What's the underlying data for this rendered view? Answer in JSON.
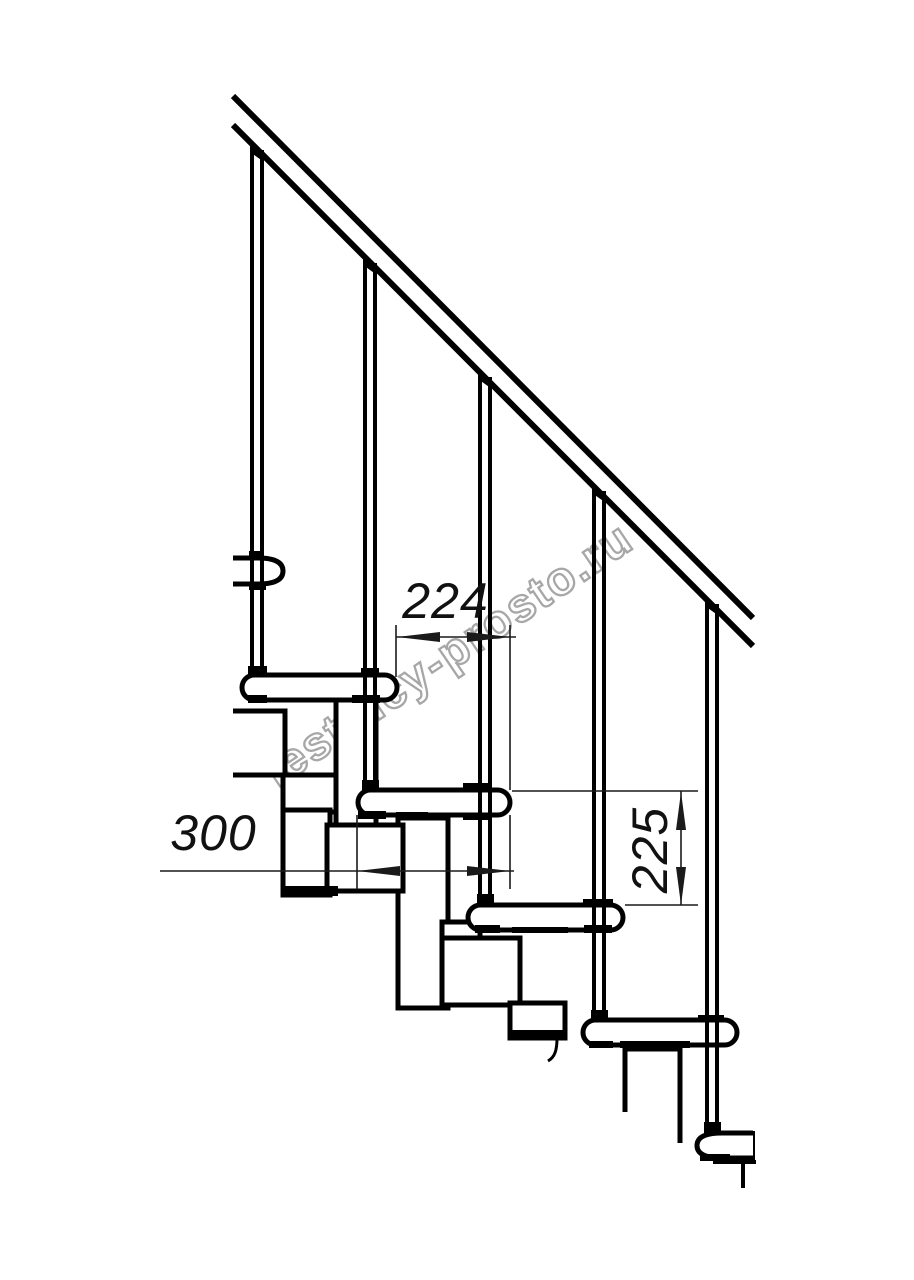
{
  "drawing": {
    "description": "Modular staircase side-view technical drawing with handrail, balusters, treads and module chain",
    "watermark_text": "lestnicy-prosto.ru",
    "dimension_labels": {
      "step_run": "224",
      "tread_width": "300",
      "step_rise": "225"
    },
    "colors": {
      "line": "#000000",
      "dimension_line": "#1a1a1a",
      "watermark_outline": "#a7a7a7",
      "background": "#ffffff"
    }
  }
}
